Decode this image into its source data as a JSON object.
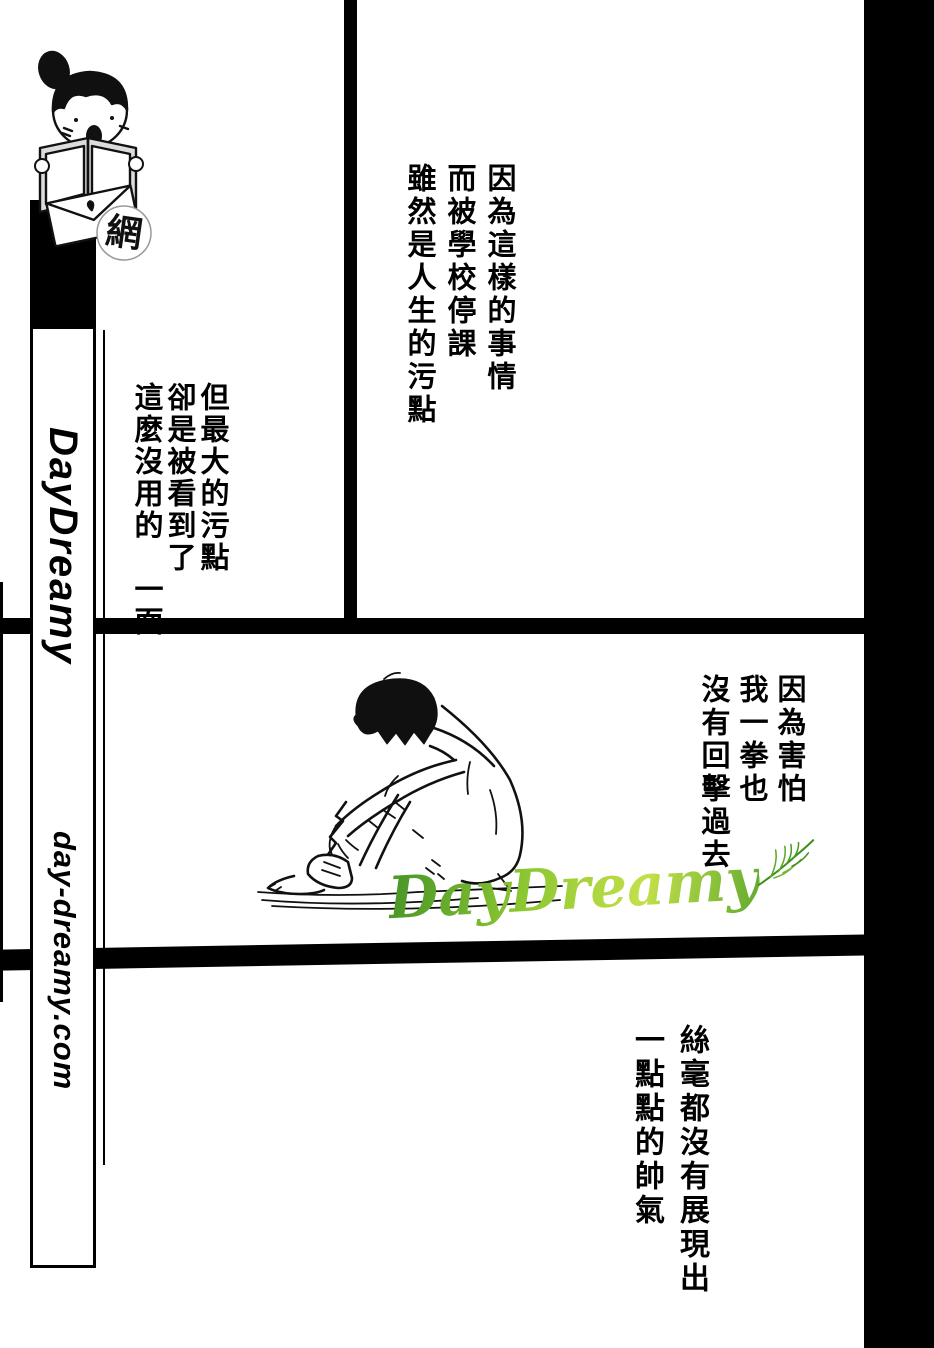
{
  "sidebar": {
    "site_name": "DayDreamy",
    "site_url": "day-dreamy.com",
    "mascot_badge": "網"
  },
  "dialogue": {
    "top_right": "因為這樣的事情\n而被學校停課\n雖然是人生的污點",
    "top_left": "但最大的污點\n卻是被看到了\n這麼沒用的　一面",
    "middle_right": "因為害怕\n我一拳也\n沒有回擊過去",
    "bottom": "絲毫都沒有展現出\n一點點的帥氣"
  },
  "watermark": {
    "logo_text": "DayDreamy",
    "green_dark": "#4e9a28",
    "green_light": "#c3e04a"
  },
  "colors": {
    "ink": "#000000",
    "paper": "#ffffff"
  }
}
